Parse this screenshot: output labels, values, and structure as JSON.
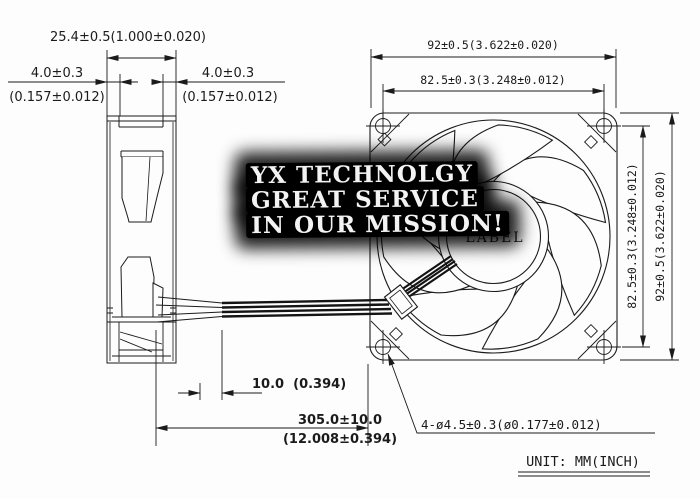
{
  "watermark": {
    "line1": "YX TECHNOLGY",
    "line2": "GREAT SERVICE",
    "line3": "IN OUR MISSION!"
  },
  "fan": {
    "hub_label": "LABEL"
  },
  "dims": {
    "thickness": "25.4±0.5(1.000±0.020)",
    "flange_mm": "4.0±0.3",
    "flange_inch": "(0.157±0.012)",
    "width_outer": "92±0.5(3.622±0.020)",
    "width_holes": "82.5±0.3(3.248±0.012)",
    "height_outer": "92±0.5(3.622±0.020)",
    "height_holes": "82.5±0.3(3.248±0.012)",
    "wire_strip": "10.0  (0.394)",
    "wire_length_mm": "305.0±10.0",
    "wire_length_inch": "(12.008±0.394)",
    "holes": "4-ø4.5±0.3(ø0.177±0.012)"
  },
  "footer": {
    "unit_label": "UNIT: MM(INCH)"
  }
}
